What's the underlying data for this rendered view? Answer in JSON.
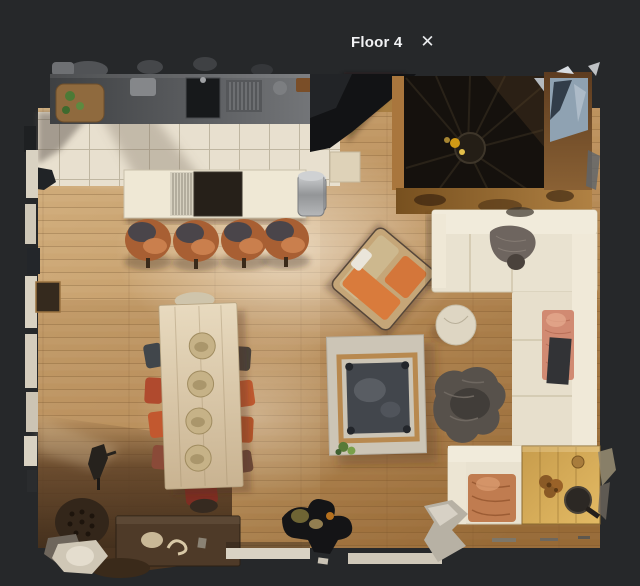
{
  "header": {
    "title": "Floor 4",
    "close_icon": "✕"
  },
  "colors": {
    "background": "#26282a",
    "title_text": "#f2f3f5",
    "floor_wood_light": "#d2af7e",
    "kitchen_tile": "#e8e0cf",
    "counter_gray": "#56585b",
    "cabinet_black": "#121315",
    "stairwell_dark": "#15110d",
    "sofa_cream": "#e9e2d0",
    "stool_leather": "#a85f33",
    "armchair_orange": "#d4763a",
    "blanket_salmon": "#d18a72",
    "rug_gray": "#57514b",
    "dining_table_wood": "#e8dabf"
  }
}
